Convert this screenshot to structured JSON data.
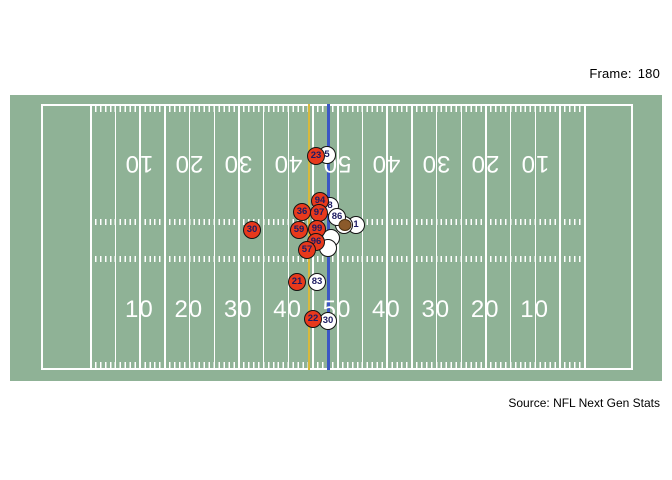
{
  "header": {
    "frame_label": "Frame:",
    "frame_value": "180"
  },
  "footer": {
    "source": "Source: NFL Next Gen Stats"
  },
  "colors": {
    "page_bg": "#ffffff",
    "field_green": "#8fb296",
    "field_lines": "#ffffff",
    "home_fill": "#e8391c",
    "away_fill": "#ffffff",
    "circle_border": "#141414",
    "number_text": "#1d1b63",
    "ball_fill": "#8b5a2b",
    "first_down_line": "#d8b93c",
    "scrimmage_line": "#3b56c4"
  },
  "chart_data": {
    "type": "scatter",
    "description": "Overhead football field player-tracking frame",
    "frame": 180,
    "yard_numbers": [
      "10",
      "20",
      "30",
      "40",
      "50",
      "40",
      "30",
      "20",
      "10"
    ],
    "special_lines": {
      "yellow_x": 308,
      "blue_x": 327
    },
    "players": [
      {
        "team": "away",
        "label": "5",
        "x": 327,
        "y": 155
      },
      {
        "team": "home",
        "label": "23",
        "x": 316,
        "y": 156
      },
      {
        "team": "away",
        "label": "8",
        "x": 330,
        "y": 206
      },
      {
        "team": "away",
        "label": "1",
        "x": 356,
        "y": 225
      },
      {
        "team": "away",
        "label": "",
        "x": 344,
        "y": 225
      },
      {
        "team": "away",
        "label": "86",
        "x": 337,
        "y": 217
      },
      {
        "team": "away",
        "label": "",
        "x": 331,
        "y": 238
      },
      {
        "team": "away",
        "label": "",
        "x": 328,
        "y": 248
      },
      {
        "team": "home",
        "label": "94",
        "x": 320,
        "y": 201
      },
      {
        "team": "home",
        "label": "97",
        "x": 319,
        "y": 213
      },
      {
        "team": "home",
        "label": "36",
        "x": 302,
        "y": 212
      },
      {
        "team": "home",
        "label": "99",
        "x": 317,
        "y": 229
      },
      {
        "team": "home",
        "label": "59",
        "x": 299,
        "y": 230
      },
      {
        "team": "home",
        "label": "96",
        "x": 316,
        "y": 242
      },
      {
        "team": "home",
        "label": "57",
        "x": 307,
        "y": 250
      },
      {
        "team": "home",
        "label": "30",
        "x": 252,
        "y": 230
      },
      {
        "team": "home",
        "label": "21",
        "x": 297,
        "y": 282
      },
      {
        "team": "away",
        "label": "83",
        "x": 317,
        "y": 282
      },
      {
        "team": "away",
        "label": "30",
        "x": 328,
        "y": 321
      },
      {
        "team": "home",
        "label": "22",
        "x": 313,
        "y": 319
      }
    ],
    "ball": {
      "x": 345,
      "y": 225
    }
  }
}
